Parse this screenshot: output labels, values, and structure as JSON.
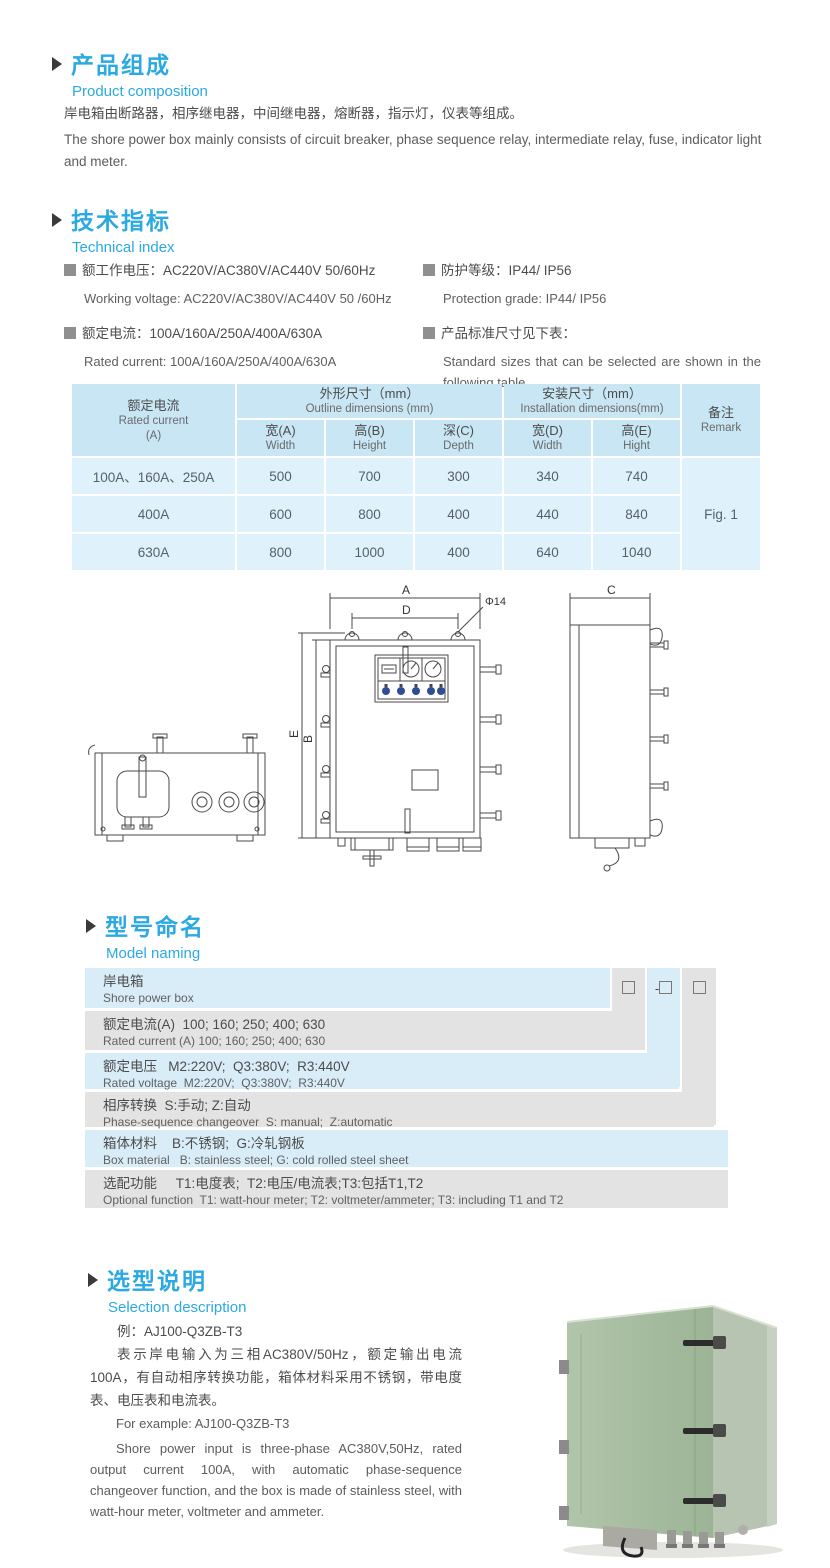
{
  "colors": {
    "accent": "#2BA9E2",
    "table_header_bg": "#C9E6F5",
    "table_cell_bg": "#DFF1FB",
    "naming_row_blue": "#D9EDF9",
    "naming_row_gray": "#E3E3E3",
    "photo_green": "#A8BEA1"
  },
  "sections": {
    "composition": {
      "title_zh": "产品组成",
      "title_en": "Product  composition",
      "para_zh": "岸电箱由断路器，相序继电器，中间继电器，熔断器，指示灯，仪表等组成。",
      "para_en": "The shore power box mainly consists of circuit breaker, phase sequence relay, intermediate relay, fuse, indicator light and meter."
    },
    "technical": {
      "title_zh": "技术指标",
      "title_en": "Technical index",
      "spec1_zh": "额工作电压：AC220V/AC380V/AC440V  50/60Hz",
      "spec1_en": "Working voltage: AC220V/AC380V/AC440V 50 /60Hz",
      "spec2_zh": "额定电流：100A/160A/250A/400A/630A",
      "spec2_en": "Rated current: 100A/160A/250A/400A/630A",
      "spec3_zh": "防护等级：IP44/ IP56",
      "spec3_en": "Protection grade: IP44/ IP56",
      "spec4_zh": "产品标准尺寸见下表：",
      "spec4_en": "Standard sizes that can be selected are shown in the following table"
    },
    "naming": {
      "title_zh": "型号命名",
      "title_en": "Model naming",
      "prefix": "AJ",
      "box": "",
      "dash": "-",
      "rows": [
        {
          "line1": "岸电箱",
          "line2": "Shore power box"
        },
        {
          "line1": "额定电流(A)  100; 160; 250; 400; 630",
          "line2": "Rated current (A) 100; 160; 250; 400; 630"
        },
        {
          "line1": "额定电压   M2:220V;  Q3:380V;  R3:440V",
          "line2": "Rated voltage  M2:220V;  Q3:380V;  R3:440V"
        },
        {
          "line1": "相序转换  S:手动; Z:自动",
          "line2": "Phase-sequence changeover  S: manual;  Z:automatic"
        },
        {
          "line1": "箱体材料    B:不锈钢;  G:冷轧钢板",
          "line2": "Box material   B: stainless steel; G: cold rolled steel sheet"
        },
        {
          "line1": "选配功能     T1:电度表;  T2:电压/电流表;T3:包括T1,T2",
          "line2": "Optional function  T1: watt-hour meter; T2: voltmeter/ammeter; T3: including T1 and T2"
        }
      ]
    },
    "selection": {
      "title_zh": "选型说明",
      "title_en": "Selection description",
      "example_zh": "例：AJ100-Q3ZB-T3",
      "para_zh": "表示岸电输入为三相AC380V/50Hz，额定输出电流100A，有自动相序转换功能，箱体材料采用不锈钢，带电度表、电压表和电流表。",
      "example_en": "For example: AJ100-Q3ZB-T3",
      "para_en": "Shore power input is three-phase AC380V,50Hz, rated output current 100A, with automatic phase-sequence changeover function, and the box is made of stainless steel, with watt-hour meter, voltmeter and ammeter."
    }
  },
  "size_table": {
    "col1_zh": "额定电流",
    "col1_en": "Rated current",
    "col1_unit": "(A)",
    "outline_zh": "外形尺寸（mm）",
    "outline_en": "Outline dimensions (mm)",
    "install_zh": "安装尺寸（mm）",
    "install_en": "Installation dimensions(mm)",
    "remark_zh": "备注",
    "remark_en": "Remark",
    "subcols": [
      {
        "zh": "宽(A)",
        "en": "Width"
      },
      {
        "zh": "高(B)",
        "en": "Height"
      },
      {
        "zh": "深(C)",
        "en": "Depth"
      },
      {
        "zh": "宽(D)",
        "en": "Width"
      },
      {
        "zh": "高(E)",
        "en": "Hight"
      }
    ],
    "rows": [
      {
        "current": "100A、160A、250A",
        "w": "500",
        "h": "700",
        "d": "300",
        "iw": "340",
        "ih": "740"
      },
      {
        "current": "400A",
        "w": "600",
        "h": "800",
        "d": "400",
        "iw": "440",
        "ih": "840"
      },
      {
        "current": "630A",
        "w": "800",
        "h": "1000",
        "d": "400",
        "iw": "640",
        "ih": "1040"
      }
    ],
    "remark_value": "Fig. 1"
  },
  "drawing": {
    "labels": {
      "A": "A",
      "B": "B",
      "C": "C",
      "D": "D",
      "E": "E",
      "phi": "Φ14"
    }
  }
}
